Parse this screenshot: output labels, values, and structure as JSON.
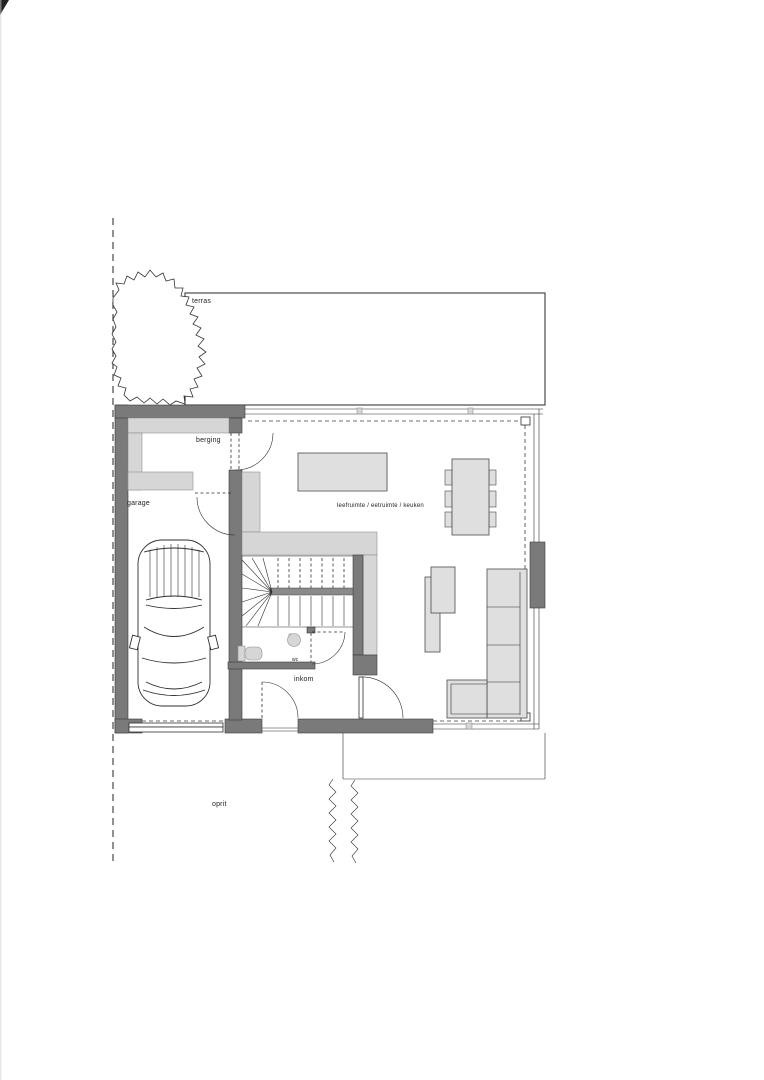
{
  "labels": {
    "terras": "terras",
    "berging": "berging",
    "garage": "garage",
    "living": "leefruimte / eetruimte / keuken",
    "wc": "wc",
    "inkom": "inkom",
    "oprit": "oprit"
  },
  "colors": {
    "wall": "#7a7a7a",
    "light": "#d6d6d6",
    "furniture": "#dfdfdf",
    "line": "#2f2f2f",
    "bg": "#ffffff",
    "label": "#222222"
  }
}
